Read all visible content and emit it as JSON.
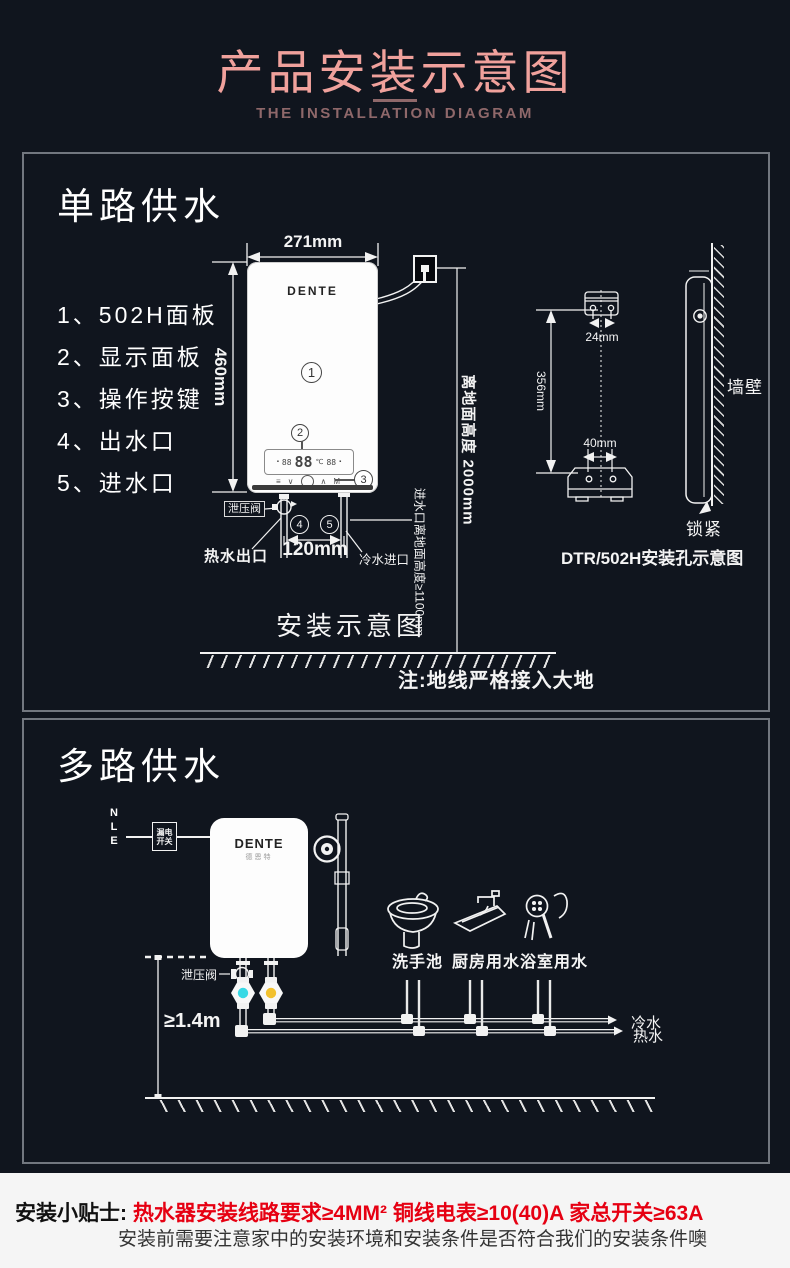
{
  "header": {
    "title": "产品安装示意图",
    "subtitle": "THE INSTALLATION DIAGRAM"
  },
  "section1": {
    "title": "单路供水",
    "parts": [
      "1、502H面板",
      "2、显示面板",
      "3、操作按键",
      "4、出水口",
      "5、进水口"
    ],
    "marks": [
      "1",
      "2",
      "3",
      "4",
      "5"
    ],
    "heater": {
      "brand": "DENTE",
      "display": {
        "aux_left": "88",
        "main": "88",
        "unit": "℃",
        "aux_right": "88"
      },
      "buttons": [
        "≡",
        "∨",
        "∧",
        "M"
      ]
    },
    "dims": {
      "width": "271mm",
      "height": "460mm",
      "pipes": "120mm",
      "socket_height": "离地面高度 2000mm",
      "inlet_height": "进水口离地面高度≥1100mm"
    },
    "labels": {
      "relief_valve": "泄压阀",
      "hot_outlet": "热水出口",
      "cold_inlet": "冷水进口",
      "caption": "安装示意图",
      "ground_note": "注:地线严格接入大地"
    },
    "mount": {
      "top_holes": "24mm",
      "bottom_holes": "40mm",
      "vertical": "356mm",
      "wall": "墙壁",
      "lock": "锁紧",
      "caption": "DTR/502H安装孔示意图"
    }
  },
  "section2": {
    "title": "多路供水",
    "wires": [
      "N",
      "L",
      "E"
    ],
    "breaker_line1": "漏电",
    "breaker_line2": "开关",
    "brand": "DENTE",
    "brand_cn": "德恩特",
    "labels": {
      "relief_valve": "泄压阀",
      "min_height": "≥1.4m",
      "cold": "冷水",
      "hot": "热水"
    },
    "fixtures": [
      "洗手池",
      "厨房用水",
      "浴室用水"
    ]
  },
  "footer": {
    "label": "安装小贴士:",
    "highlight": "热水器安装线路要求≥4MM²  铜线电表≥10(40)A 家总开关≥63A",
    "note": "安装前需要注意家中的安装环境和安装条件是否符合我们的安装条件噢"
  },
  "colors": {
    "background": "#10151e",
    "title_pink": "#f0a19c",
    "subtitle_mauve": "#8f686a",
    "box_border": "#72777f",
    "warning_red": "#e60012",
    "valve_cyan": "#38d9e5",
    "valve_yellow": "#f2c12e",
    "footer_bg": "#f5f5f5"
  }
}
